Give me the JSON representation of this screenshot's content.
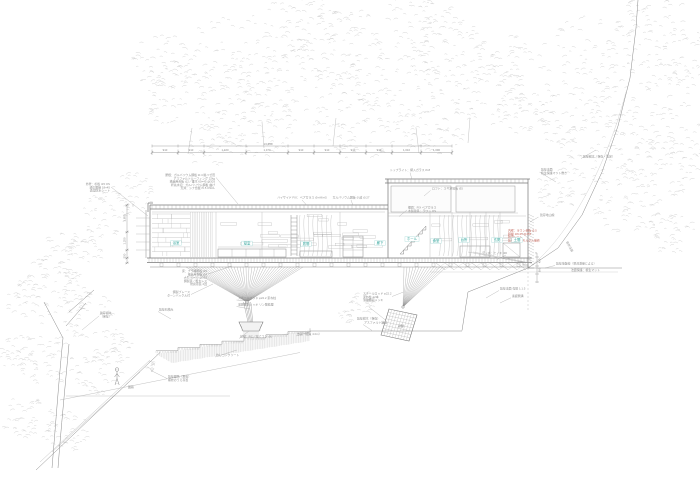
{
  "meta": {
    "drawing_type": "断面詳細図"
  },
  "colors": {
    "teal": "#2fa39a",
    "teal_box": "#9fd8d4",
    "red": "#c4695e",
    "ink": "#777777",
    "annotation": "#909090",
    "dim": "#8a8a8a",
    "foliage": "#cccccc"
  },
  "top_dimension": {
    "total": "13,650",
    "segments": [
      {
        "label": "910"
      },
      {
        "label": "910"
      },
      {
        "label": "1,470"
      },
      {
        "label": "1,470"
      },
      {
        "label": "910"
      },
      {
        "label": "910"
      },
      {
        "label": "910"
      },
      {
        "label": "910"
      },
      {
        "label": "1,010"
      },
      {
        "label": "1,090"
      }
    ]
  },
  "left_dimension": {
    "labels": [
      "1,850",
      "1,250",
      "550"
    ]
  },
  "right_dimension": {
    "labels": [
      "450",
      "600"
    ]
  },
  "rooms": [
    {
      "x": 176,
      "y": 244,
      "label": "浴室"
    },
    {
      "x": 247,
      "y": 244.5,
      "label": "寝室"
    },
    {
      "x": 306,
      "y": 245,
      "label": "居間"
    },
    {
      "x": 380,
      "y": 244,
      "label": "廊下"
    },
    {
      "x": 412,
      "y": 240,
      "label": "ホール"
    },
    {
      "x": 436,
      "y": 242,
      "label": "食堂"
    },
    {
      "x": 464,
      "y": 241,
      "label": "台所"
    },
    {
      "x": 497,
      "y": 241,
      "label": "玄関"
    },
    {
      "x": 517,
      "y": 241,
      "label": "土間"
    }
  ],
  "annotations": [
    {
      "x": 215,
      "y": 176,
      "a": "end",
      "lines": [
        "屋根：ガルバリウム鋼板 t0.4 縦ハゼ葺",
        "アスファルトルーフィング 22kg",
        "構造用合板 t12／垂木 60×45 @303",
        "軒先水切：ガルバリウム鋼板 曲げ",
        "天井：シナ合板 t5.5 OSCL"
      ]
    },
    {
      "x": 110,
      "y": 185,
      "a": "end",
      "lines": [
        "外壁：杉板 t15 OS",
        "通気胴縁 18×45",
        "透湿防水シート"
      ]
    },
    {
      "x": 302,
      "y": 198.5,
      "a": "middle",
      "lines": [
        "ハイサイド FIX：ペアガラス t5+A6+t5"
      ]
    },
    {
      "x": 351,
      "y": 198.5,
      "a": "middle",
      "lines": [
        "ガルバリウム鋼板 小波 t0.27"
      ]
    },
    {
      "x": 410,
      "y": 171,
      "a": "middle",
      "lines": [
        "トップライト：網入ガラス t6.8"
      ]
    },
    {
      "x": 408,
      "y": 208.5,
      "a": "start",
      "lines": [
        "欄間：FIX ペアガラス",
        "木製建具：ラワン OS"
      ]
    },
    {
      "x": 432,
      "y": 189.5,
      "a": "start",
      "lines": [
        "ロフト：スギ足場板 t35"
      ]
    },
    {
      "x": 508,
      "y": 231.5,
      "a": "start",
      "c": "red",
      "lines": [
        "内壁：ラワン合板 t5.5",
        "胴縁 18×45 @455",
        "防湿シート",
        "既存擁壁：モルタル補修"
      ]
    },
    {
      "x": 583,
      "y": 157.5,
      "a": "start",
      "lines": [
        "既存樹木（保存・剪定）"
      ]
    },
    {
      "x": 541,
      "y": 170.5,
      "a": "start",
      "lines": [
        "既存法面",
        "植生保護マット敷き"
      ]
    },
    {
      "x": 566,
      "y": 242,
      "a": "start",
      "rot": 62,
      "lines": [
        "既存法面"
      ]
    },
    {
      "x": 540,
      "y": 216,
      "a": "start",
      "lines": [
        "既存地山線"
      ]
    },
    {
      "x": 556,
      "y": 264.5,
      "a": "start",
      "lines": [
        "既存地盤線（現況測量による）"
      ]
    },
    {
      "x": 571,
      "y": 271,
      "a": "start",
      "lines": [
        "法面保護：植生マット"
      ]
    },
    {
      "x": 507,
      "y": 254,
      "a": "end",
      "lines": [
        "デッキ：ヒノキ t30"
      ]
    },
    {
      "x": 207,
      "y": 272,
      "a": "end",
      "lines": [
        "床：ナラ縁甲板 t15",
        "構造用合板 t24",
        "大引 90×90 @910",
        "鋼製束／根太レス",
        "防腐塗装 2回"
      ]
    },
    {
      "x": 190,
      "y": 293,
      "a": "end",
      "lines": [
        "鋼製ブレース",
        "ターンバックル付"
      ]
    },
    {
      "x": 238,
      "y": 299,
      "a": "start",
      "lines": [
        "スチールロッド φ22.2 束ね柱"
      ]
    },
    {
      "x": 238,
      "y": 305.5,
      "a": "start",
      "lines": [
        "溶融亜鉛メッキ リン酸処理"
      ]
    },
    {
      "x": 240,
      "y": 337.5,
      "a": "start",
      "lines": [
        "基礎：RC／捨てコン t50"
      ]
    },
    {
      "x": 216,
      "y": 356,
      "a": "start",
      "lines": [
        "均しコンクリート"
      ]
    },
    {
      "x": 100,
      "y": 314,
      "a": "start",
      "lines": [
        "既存樹木",
        "（保存）"
      ]
    },
    {
      "x": 159,
      "y": 310.5,
      "a": "start",
      "lines": [
        "既存石積み"
      ]
    },
    {
      "x": 363,
      "y": 294.5,
      "a": "start",
      "lines": [
        "スチールロッド φ22.2",
        "束ね柱 12本",
        "溶融亜鉛メッキ"
      ]
    },
    {
      "x": 357,
      "y": 319.5,
      "a": "start",
      "lines": [
        "既存樹木（保存）"
      ]
    },
    {
      "x": 398,
      "y": 327,
      "a": "start",
      "lines": [
        "基礎"
      ]
    },
    {
      "x": 364,
      "y": 323.5,
      "a": "start",
      "lines": [
        "アスファルト舗装"
      ]
    },
    {
      "x": 297,
      "y": 335,
      "a": "start",
      "lines": [
        "市道（幅員 4.0m）"
      ]
    },
    {
      "x": 168,
      "y": 377.5,
      "a": "start",
      "lines": [
        "既存園路（飛石）",
        "補修のうえ存置"
      ]
    },
    {
      "x": 128,
      "y": 388,
      "a": "start",
      "lines": [
        "園路"
      ]
    },
    {
      "x": 500,
      "y": 289.5,
      "a": "start",
      "lines": [
        "既存法面 勾配 1:1.5"
      ]
    },
    {
      "x": 512,
      "y": 297,
      "a": "start",
      "lines": [
        "素掘側溝"
      ]
    },
    {
      "x": 133,
      "y": 206.5,
      "a": "middle",
      "lines": [
        "▽"
      ]
    },
    {
      "x": 536,
      "y": 254,
      "a": "middle",
      "lines": [
        "▽"
      ]
    }
  ],
  "leaders": [
    [
      216,
      177.5,
      238,
      204
    ],
    [
      111,
      187,
      148,
      216
    ],
    [
      302,
      200,
      307,
      205.5
    ],
    [
      351,
      200,
      353,
      205.5
    ],
    [
      410,
      172.5,
      412,
      179.5
    ],
    [
      407,
      210,
      399,
      216.5
    ],
    [
      430.5,
      190.5,
      424,
      196
    ],
    [
      522,
      233,
      528,
      238
    ],
    [
      581,
      158.5,
      596,
      150
    ],
    [
      539.5,
      172,
      556,
      182
    ],
    [
      538.5,
      217,
      530,
      222
    ],
    [
      555,
      265.5,
      545,
      268
    ],
    [
      506,
      255,
      497,
      259.5
    ],
    [
      208,
      274,
      232,
      266
    ],
    [
      191,
      294.5,
      213,
      284
    ],
    [
      236.5,
      300,
      247.5,
      301
    ],
    [
      236.5,
      306.5,
      250,
      309
    ],
    [
      239,
      338.5,
      249,
      331
    ],
    [
      215,
      357,
      237,
      350
    ],
    [
      99,
      316,
      82,
      330
    ],
    [
      158,
      311.5,
      171,
      319
    ],
    [
      392,
      296.5,
      403.5,
      292
    ],
    [
      386,
      320.5,
      369,
      307
    ],
    [
      397.5,
      327.5,
      402,
      324.5
    ],
    [
      363,
      324.5,
      372,
      330.5
    ],
    [
      296,
      336,
      311,
      331.5
    ],
    [
      167,
      378.5,
      153,
      371.5
    ],
    [
      499,
      290.5,
      486,
      298
    ],
    [
      511,
      297.8,
      500,
      303
    ]
  ]
}
